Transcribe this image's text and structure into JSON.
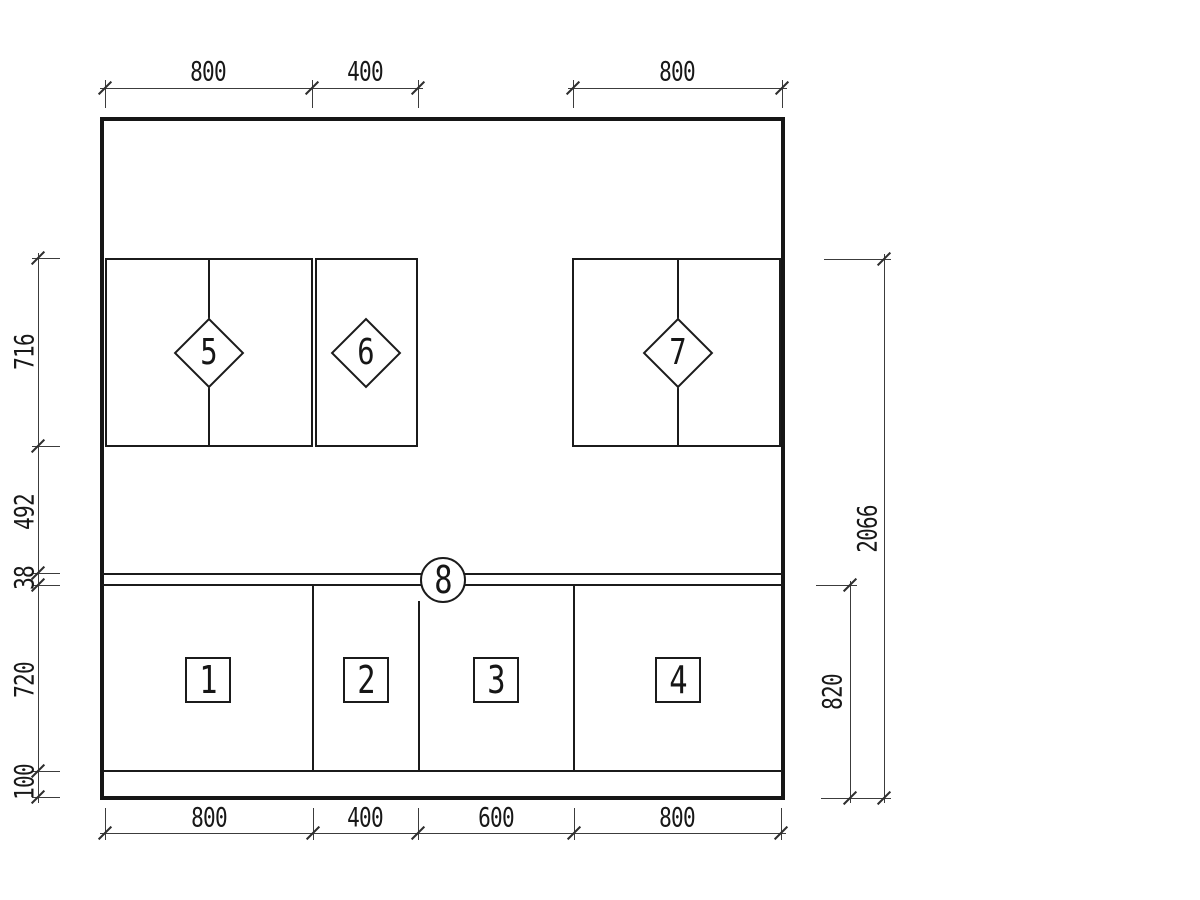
{
  "colors": {
    "background": "#ffffff",
    "drawing_line": "#1b1b1b",
    "dimension_line": "#3c3c3c",
    "text": "#181818"
  },
  "dims": {
    "top": [
      "800",
      "400",
      "800"
    ],
    "bottom": [
      "800",
      "400",
      "600",
      "800"
    ],
    "left": [
      "716",
      "492",
      "38",
      "720",
      "100"
    ],
    "right": [
      "2066",
      "820"
    ]
  },
  "markers": {
    "squares": [
      "1",
      "2",
      "3",
      "4"
    ],
    "diamonds": [
      "5",
      "6",
      "7"
    ],
    "circle": "8"
  }
}
